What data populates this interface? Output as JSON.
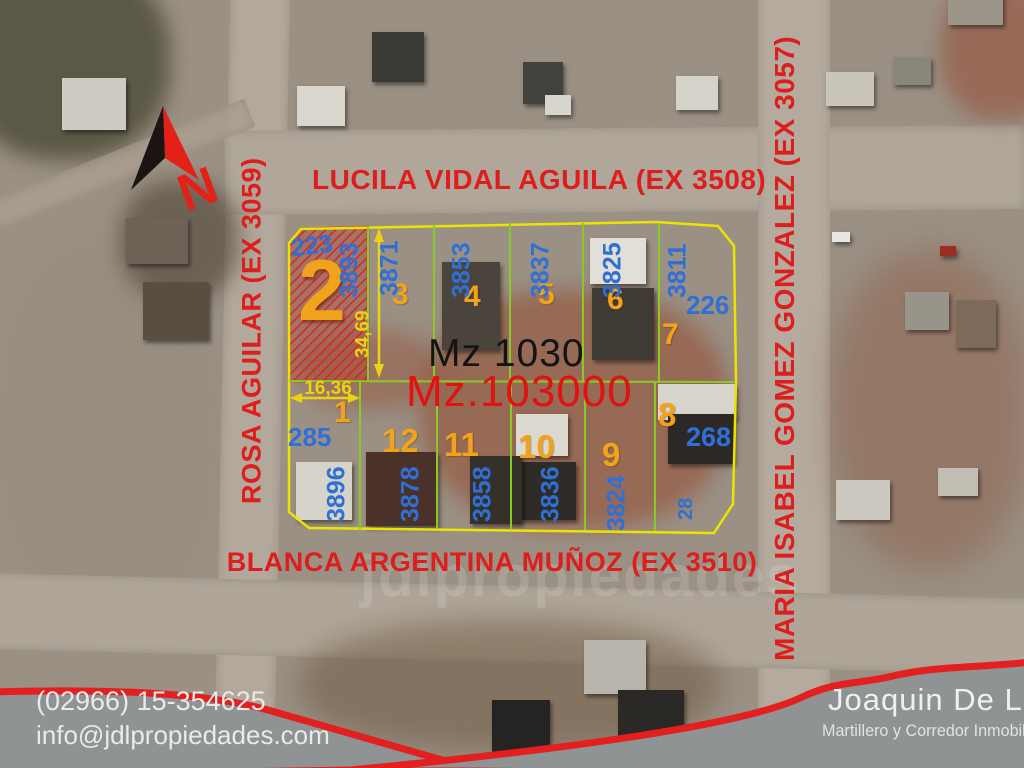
{
  "map": {
    "streets": {
      "top": "LUCILA VIDAL AGUILA (EX 3508)",
      "bottom": "BLANCA ARGENTINA MUÑOZ (EX 3510)",
      "left": "ROSA AGUILAR (EX 3059)",
      "right": "MARIA ISABEL GOMEZ GONZALEZ (EX 3057)"
    },
    "block_labels": {
      "primary": "Mz 1030",
      "secondary": "Mz.103000"
    },
    "north_label": "N",
    "watermark": "jdlpropiedades",
    "dimensions": {
      "frontage": "16,36",
      "depth": "34,69"
    },
    "highlighted_lot": "2",
    "lots": {
      "top_row": [
        {
          "number": "2",
          "parcel": "3893",
          "corner": "223"
        },
        {
          "number": "3",
          "parcel": "3871"
        },
        {
          "number": "4",
          "parcel": "3853"
        },
        {
          "number": "5",
          "parcel": "3837"
        },
        {
          "number": "6",
          "parcel": "3825"
        },
        {
          "number": "7",
          "parcel": "3811",
          "corner": "226"
        }
      ],
      "bottom_row": [
        {
          "number": "1",
          "parcel": "3896",
          "corner": "285"
        },
        {
          "number": "12",
          "parcel": "3878"
        },
        {
          "number": "11",
          "parcel": "3858"
        },
        {
          "number": "10",
          "parcel": "3836"
        },
        {
          "number": "9",
          "parcel": "3824"
        },
        {
          "number": "8",
          "parcel": "28",
          "corner": "268"
        }
      ]
    }
  },
  "footer": {
    "contact": {
      "phone": "(02966) 15-354625",
      "email": "info@jdlpropiedades.com"
    },
    "agent": {
      "name": "Joaquin De Luc",
      "title": "Martillero y Corredor Inmobilia"
    }
  },
  "colors": {
    "street_text": "#de1d1d",
    "parcel_number": "#2f6fd6",
    "lot_number": "#f2a31c",
    "block_outline": "#ece400",
    "inner_lines": "#8bc926",
    "highlight_hatch": "#d5281e",
    "dimension_text": "#ecd40c",
    "banner_red": "#e41f1f",
    "banner_gray": "#8f9394"
  }
}
